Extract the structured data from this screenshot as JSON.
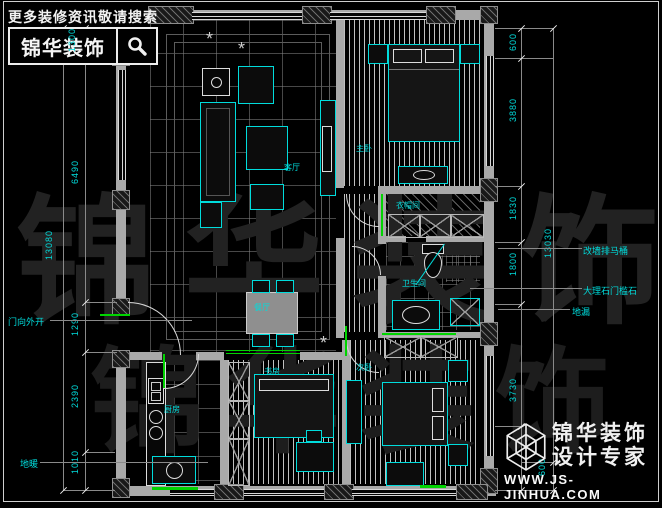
{
  "header": {
    "tagline": "更多装修资讯敬请搜索",
    "brand": "锦华装饰"
  },
  "footer": {
    "line1": "锦华装饰",
    "line2": "设计专家",
    "url": "WWW.JS-JINHUA.COM"
  },
  "watermark": "锦华装饰",
  "rooms": {
    "living": "客厅",
    "dining": "餐厅",
    "master": "主卧",
    "cloak": "衣帽间",
    "bath": "卫生间",
    "kitchen": "厨房",
    "study": "书房",
    "second": "次卧"
  },
  "annotations": {
    "door": "门向外开",
    "heating": "地暖",
    "toilet": "改墙排马桶",
    "threshold": "大理石门槛石",
    "drain": "地漏"
  },
  "dimensions": {
    "left_outer": "13080",
    "left_inner": [
      "6490",
      "1290",
      "2390",
      "1010"
    ],
    "right_outer": "13030",
    "right_inner": [
      "600",
      "3880",
      "1830",
      "1800",
      "3730",
      "600"
    ],
    "top_left": "1300"
  }
}
